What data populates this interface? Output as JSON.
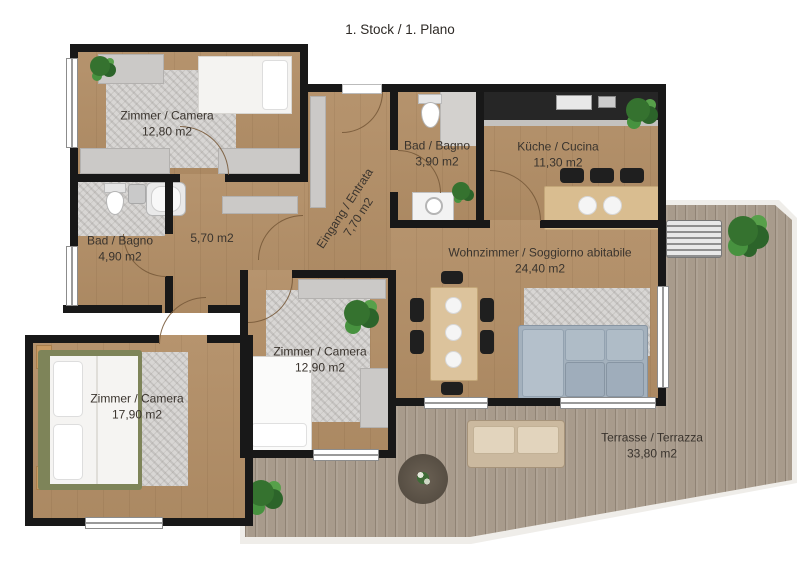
{
  "title": "1. Stock / 1. Plano",
  "rooms": [
    {
      "id": "bedroom-1",
      "name": "Zimmer / Camera",
      "area": "12,80 m2"
    },
    {
      "id": "bath-1",
      "name": "Bad / Bagno",
      "area": "4,90 m2"
    },
    {
      "id": "hallway",
      "name": "",
      "area": "5,70 m2"
    },
    {
      "id": "entrance",
      "name": "Eingang / Entrata",
      "area": "7,70 m2"
    },
    {
      "id": "bath-2",
      "name": "Bad / Bagno",
      "area": "3,90 m2"
    },
    {
      "id": "kitchen",
      "name": "Küche / Cucina",
      "area": "11,30 m2"
    },
    {
      "id": "living-room",
      "name": "Wohnzimmer / Soggiorno abitabile",
      "area": "24,40 m2"
    },
    {
      "id": "bedroom-2",
      "name": "Zimmer / Camera",
      "area": "12,90 m2"
    },
    {
      "id": "bedroom-3",
      "name": "Zimmer / Camera",
      "area": "17,90 m2"
    },
    {
      "id": "terrace",
      "name": "Terrasse / Terrazza",
      "area": "33,80 m2"
    }
  ],
  "colors": {
    "wall": "#181818",
    "wood_floor": "#b28e66",
    "terrace_deck": "#a89b8c",
    "rug": "#d8d6d4",
    "plant_green": "#35722f",
    "sofa_blue": "#a4b1bd",
    "counter_dark": "#262626",
    "label_text": "#3a342e"
  }
}
